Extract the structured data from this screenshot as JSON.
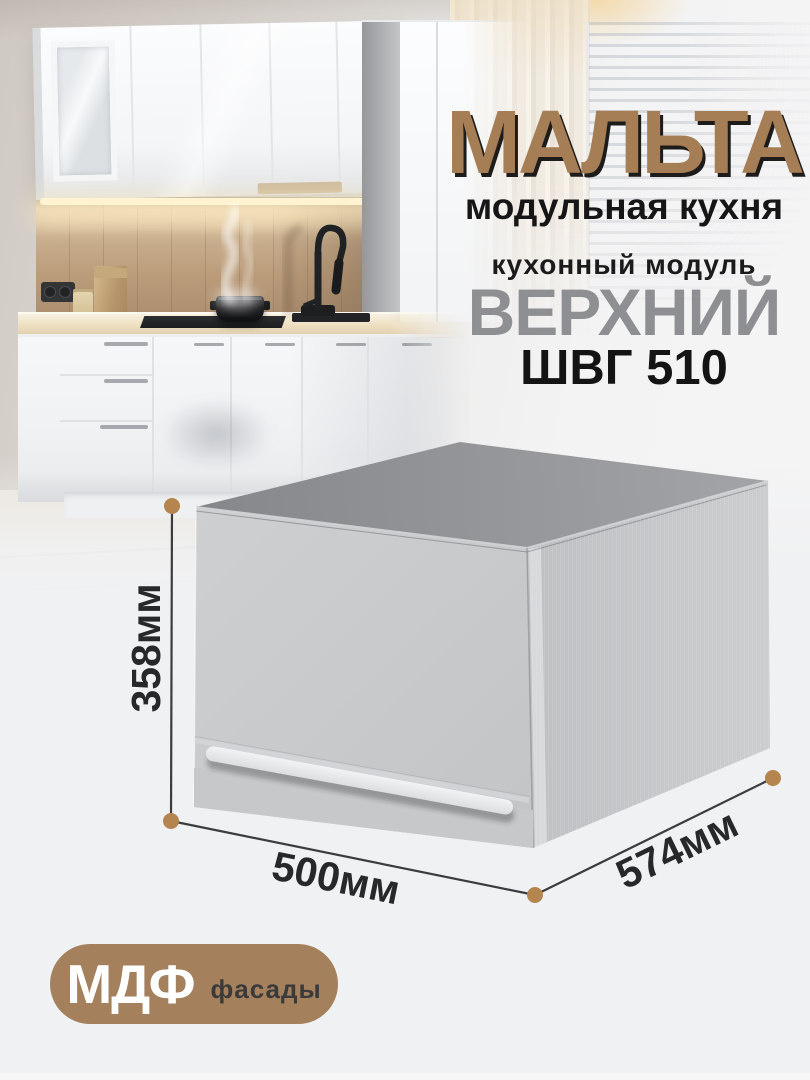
{
  "colors": {
    "background": "#f0f1f2",
    "accent_brown": "#a67e56",
    "title_shadow": "#1e1c1a",
    "product_name_gray": "#8d8f92",
    "dimension_dot": "#b5854f",
    "dimension_line": "#3b3c3e",
    "badge_bg": "#a5805d",
    "badge_title_color": "#ffffff",
    "badge_label_color": "#3a3a3a"
  },
  "branding": {
    "title": "МАЛЬТА",
    "subtitle": "модульная кухня"
  },
  "product": {
    "kicker": "кухонный модуль",
    "name": "ВЕРХНИЙ",
    "model": "ШВГ 510"
  },
  "dimensions": {
    "height_label": "358мм",
    "width_label": "500мм",
    "depth_label": "574мм"
  },
  "badge": {
    "title": "МДФ",
    "label": "фасады"
  }
}
